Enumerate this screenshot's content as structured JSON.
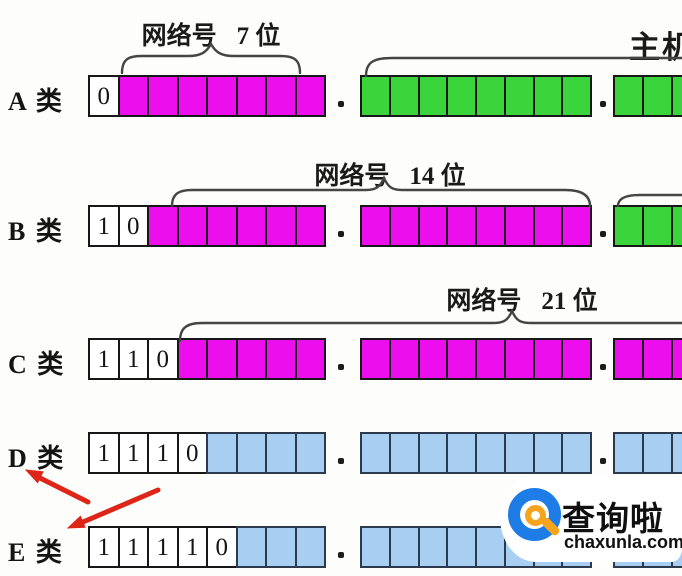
{
  "title": "IP address classes bit layout",
  "colors": {
    "network_magenta": "#ED0EED",
    "host_green": "#3BD43B",
    "reserved_blue": "#A8CFF2",
    "arrow_red": "#DF2418",
    "brand_blue": "#1D7CE6",
    "brand_orange": "#F6A41C"
  },
  "octet_separator": ".",
  "rows": [
    {
      "label": "A 类",
      "bits": [
        "0"
      ],
      "octet1_color": "magenta",
      "octet2_color": "green",
      "octet3_color": "green"
    },
    {
      "label": "B 类",
      "bits": [
        "1",
        "0"
      ],
      "octet1_color": "magenta",
      "octet2_color": "magenta",
      "octet3_color": "green"
    },
    {
      "label": "C 类",
      "bits": [
        "1",
        "1",
        "0"
      ],
      "octet1_color": "magenta",
      "octet2_color": "magenta",
      "octet3_color": "magenta"
    },
    {
      "label": "D 类",
      "bits": [
        "1",
        "1",
        "1",
        "0"
      ],
      "octet1_color": "blue",
      "octet2_color": "blue",
      "octet3_color": "blue"
    },
    {
      "label": "E 类",
      "bits": [
        "1",
        "1",
        "1",
        "1",
        "0"
      ],
      "octet1_color": "blue",
      "octet2_color": "blue",
      "octet3_color": "blue"
    }
  ],
  "braces": {
    "a_network": {
      "label": "网络号",
      "bits": "7 位"
    },
    "b_network": {
      "label": "网络号",
      "bits": "14 位"
    },
    "c_network": {
      "label": "网络号",
      "bits": "21 位"
    }
  },
  "host_brace": {
    "label": "主机号"
  },
  "watermark": {
    "name": "查询啦",
    "domain": "chaxunla.com"
  }
}
